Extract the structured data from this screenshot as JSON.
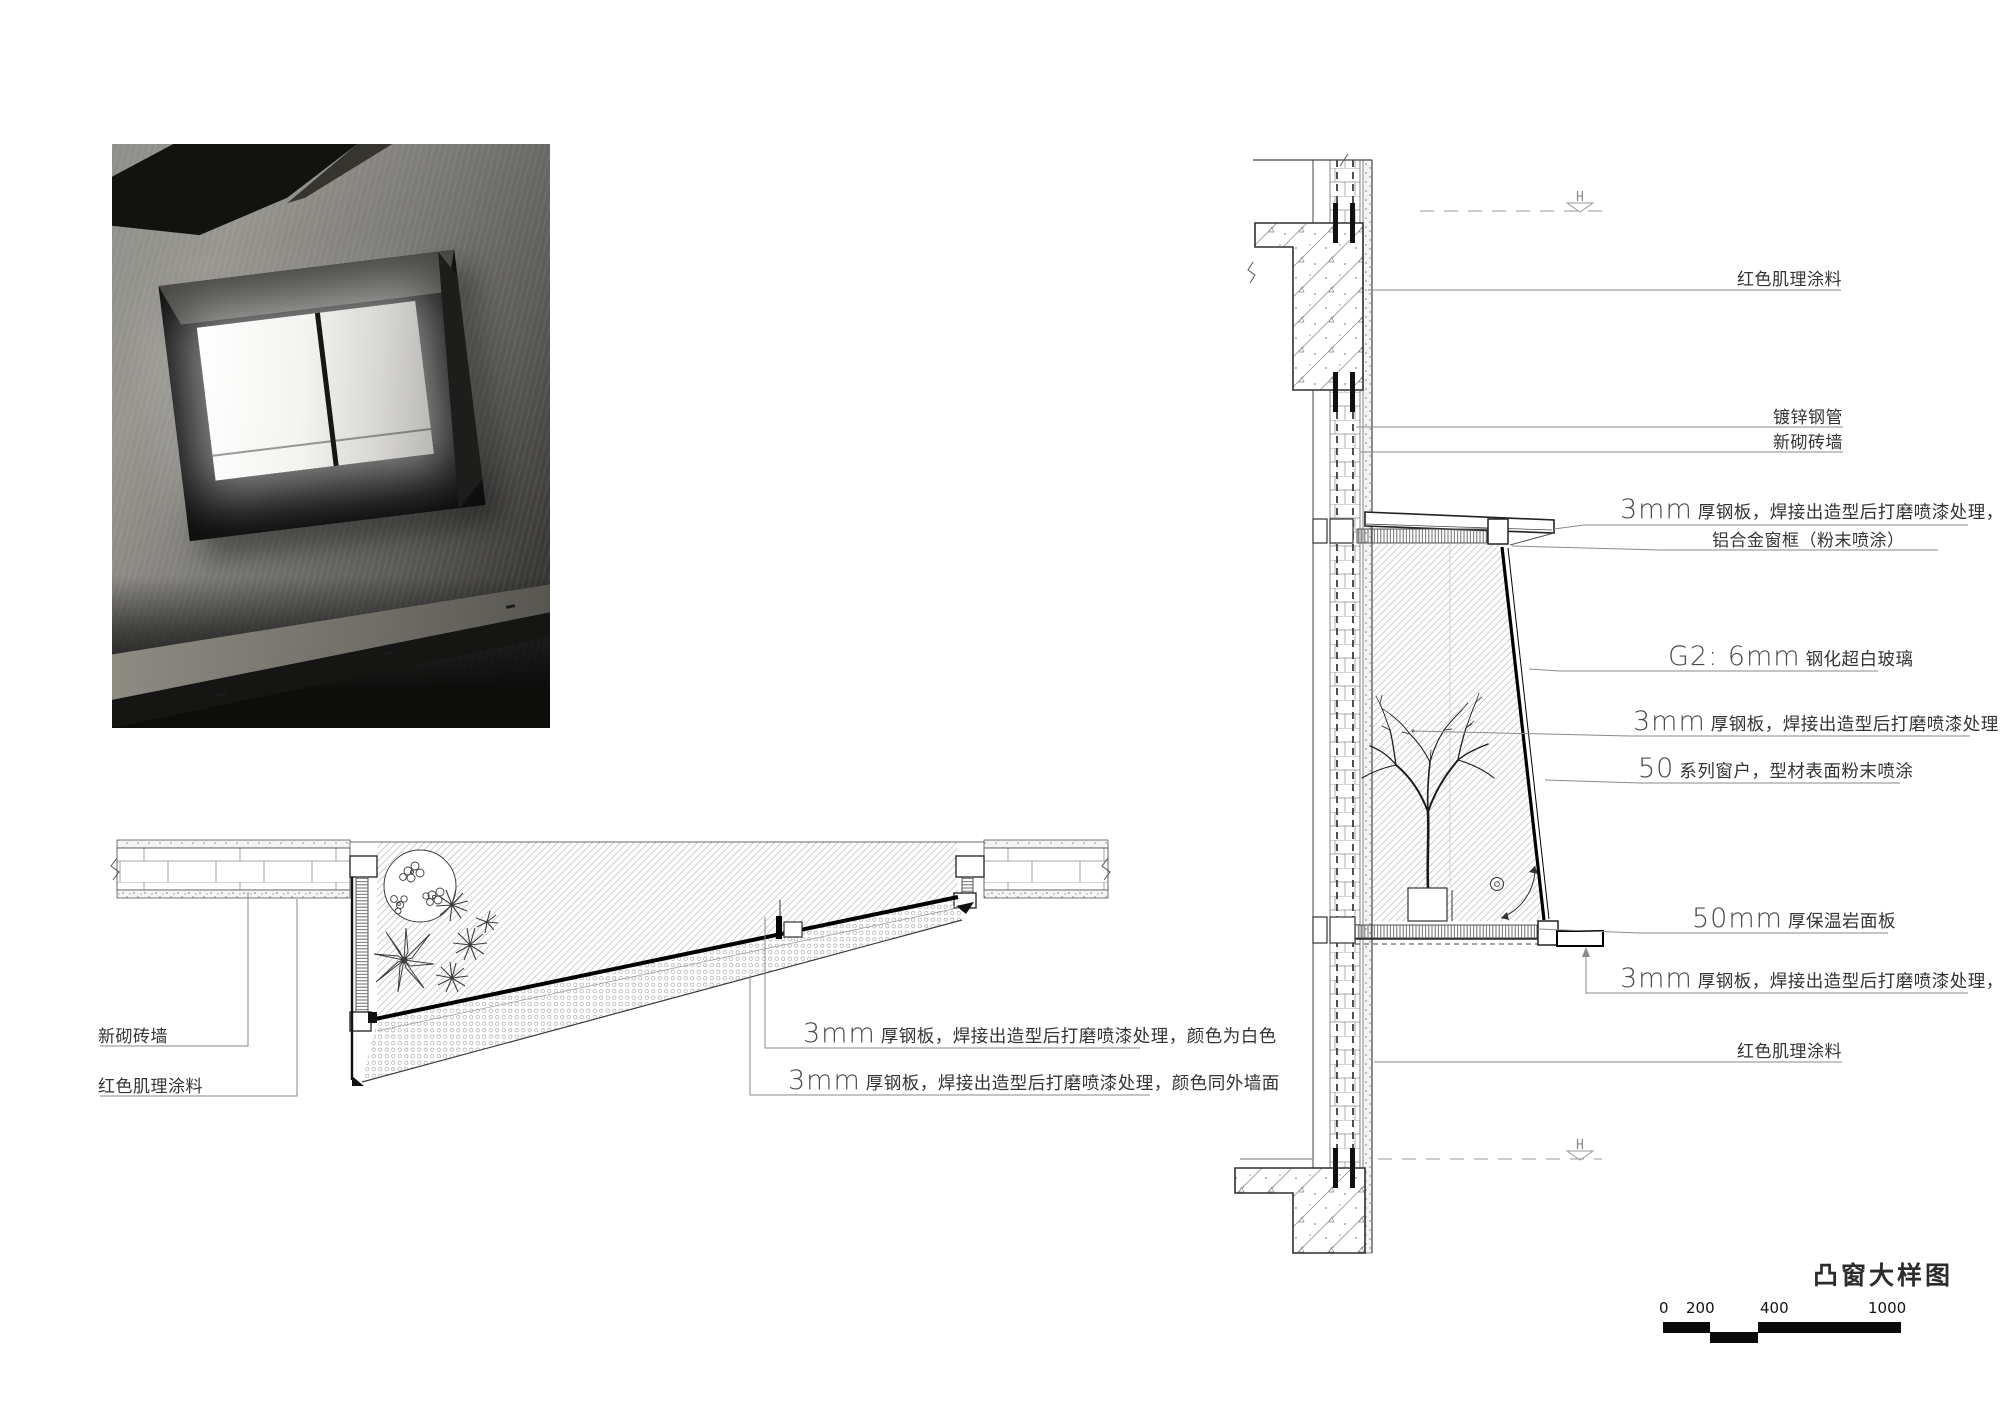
{
  "title": {
    "text": "凸窗大样图"
  },
  "levels": {
    "upper": "H",
    "lower": "H"
  },
  "scale_bar": {
    "labels": [
      "0",
      "200",
      "400",
      "1000"
    ]
  },
  "plan": {
    "labels": [
      {
        "num": "",
        "text": "新砌砖墙"
      },
      {
        "num": "",
        "text": "红色肌理涂料"
      },
      {
        "num": "3mm",
        "text": "厚钢板，焊接出造型后打磨喷漆处理，颜色为白色"
      },
      {
        "num": "3mm",
        "text": "厚钢板，焊接出造型后打磨喷漆处理，颜色同外墙面"
      }
    ]
  },
  "section": {
    "labels": [
      {
        "num": "",
        "text": "红色肌理涂料"
      },
      {
        "num": "",
        "text": "镀锌钢管"
      },
      {
        "num": "",
        "text": "新砌砖墙"
      },
      {
        "num": "3mm",
        "text": "厚钢板，焊接出造型后打磨喷漆处理，颜色同外墙面"
      },
      {
        "num": "",
        "text": "铝合金窗框（粉末喷涂）"
      },
      {
        "num": "G2: 6mm",
        "text": "钢化超白玻璃"
      },
      {
        "num": "3mm",
        "text": "厚钢板，焊接出造型后打磨喷漆处理，颜色为白色"
      },
      {
        "num": "50",
        "text": "系列窗户，型材表面粉末喷涂"
      },
      {
        "num": "50mm",
        "text": "厚保温岩面板"
      },
      {
        "num": "3mm",
        "text": "厚钢板，焊接出造型后打磨喷漆处理，颜色同外墙面"
      },
      {
        "num": "",
        "text": "红色肌理涂料"
      }
    ]
  },
  "colors": {
    "paper": "#ffffff",
    "line": "#4a4a4a",
    "leader": "#8a8a8a",
    "hatch": "#c4c4c4",
    "glass": "#000000"
  }
}
